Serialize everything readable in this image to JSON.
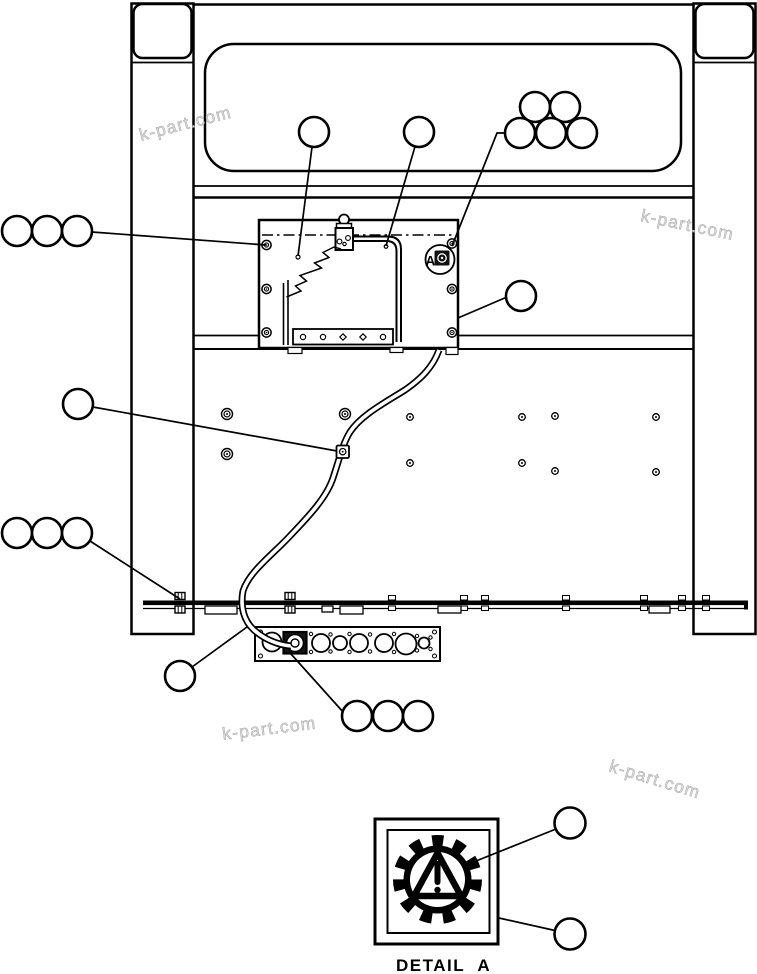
{
  "page": {
    "type": "exploded-parts-diagram",
    "background": "#ffffff",
    "line_color": "#000000"
  },
  "watermark": {
    "text": "k-part.com",
    "color": "#d9d9d9",
    "count": 4
  },
  "panel": {
    "detail_marker_label": "A",
    "decal_icon": "gear-warning-triangle-icon"
  },
  "detail_inset": {
    "label": "DETAIL A",
    "icon": "gear-warning-triangle-icon"
  },
  "callouts": {
    "balloon_count": 21,
    "style": "empty unnumbered circles"
  }
}
